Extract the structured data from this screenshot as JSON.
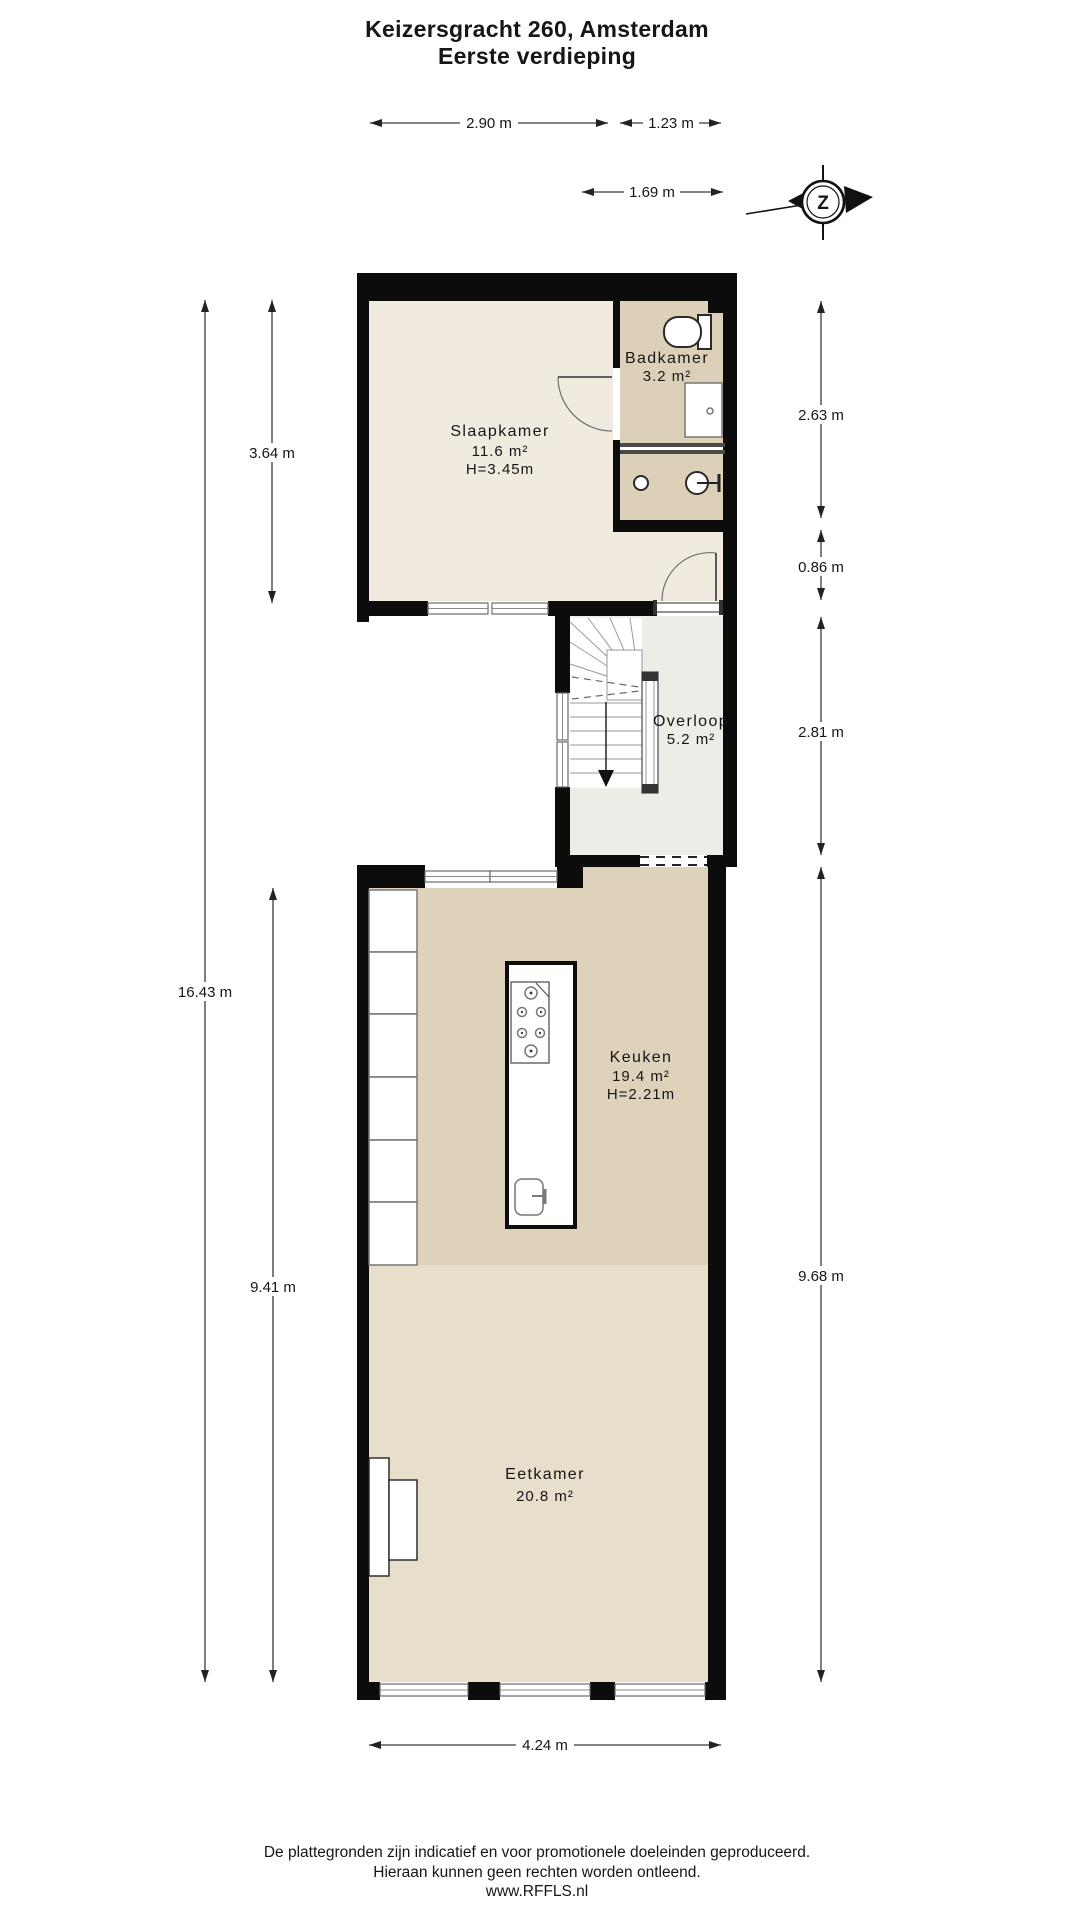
{
  "title": {
    "line1": "Keizersgracht 260, Amsterdam",
    "line2": "Eerste verdieping"
  },
  "compass": {
    "letter": "Z"
  },
  "rooms": {
    "slaapkamer": {
      "name": "Slaapkamer",
      "area": "11.6 m²",
      "ceiling": "H=3.45m"
    },
    "badkamer": {
      "name": "Badkamer",
      "area": "3.2 m²"
    },
    "overloop": {
      "name": "Overloop",
      "area": "5.2 m²"
    },
    "keuken": {
      "name": "Keuken",
      "area": "19.4 m²",
      "ceiling": "H=2.21m"
    },
    "eetkamer": {
      "name": "Eetkamer",
      "area": "20.8 m²"
    }
  },
  "dimensions": {
    "slaapkamer_width": "2.90 m",
    "badkamer_width": "1.23 m",
    "overloop_width": "1.69 m",
    "slaapkamer_height_left": "3.64 m",
    "total_height_left": "16.43 m",
    "lower_height_left": "9.41 m",
    "badkamer_height_right": "2.63 m",
    "hall_height_right": "0.86 m",
    "overloop_height_right": "2.81 m",
    "lower_height_right": "9.68 m",
    "eetkamer_width_bottom": "4.24 m"
  },
  "footer": {
    "line1": "De plattegronden zijn indicatief en voor promotionele doeleinden geproduceerd.",
    "line2": "Hieraan kunnen geen rechten worden ontleend.",
    "line3": "www.RFFLS.nl"
  },
  "colors": {
    "wall": "#0c0c0c",
    "slaapkamer": "#f0eadf",
    "badkamer": "#ddd0b8",
    "overloop": "#ecede6",
    "keuken": "#ded2ba",
    "eetkamer": "#e7decb"
  }
}
